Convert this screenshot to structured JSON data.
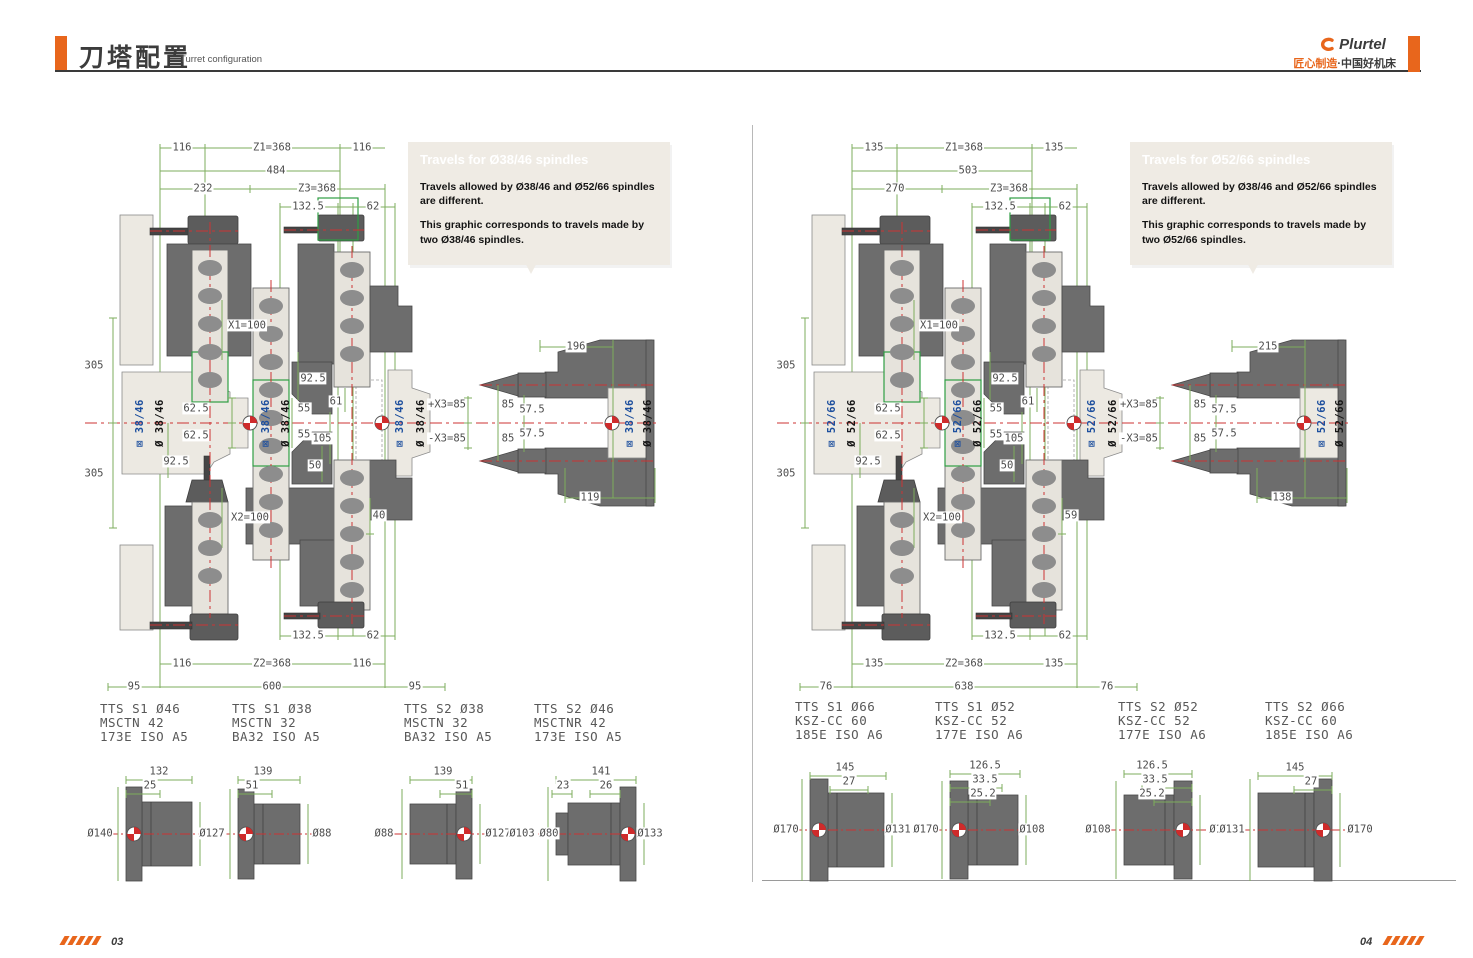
{
  "header": {
    "title_cn": "刀塔配置",
    "title_en": "Turret configuration",
    "brand": "Plurtel",
    "tagline_orange": "匠心制造",
    "tagline_dark": "·中国好机床"
  },
  "footer": {
    "page_left": "03",
    "page_right": "04"
  },
  "colors": {
    "accent_orange": "#E8661C",
    "dimension_green": "#7dad5c",
    "highlight_green": "#2f9e44",
    "centerline_red": "#cc3333",
    "spindle_blue": "#1d4f9e",
    "machine_gray": "#6d6d6d",
    "machine_beige": "#ECE9E2",
    "callout_bg": "#EFEBE4"
  },
  "left_panel": {
    "callout": {
      "title": "Travels for Ø38/46 spindles",
      "para1": "Travels allowed by Ø38/46  and Ø52/66  spindles are different.",
      "para2": "This graphic corresponds to travels made by two Ø38/46  spindles."
    },
    "spindle_blue": "⊠ 38/46",
    "spindle_black": "Ø 38/46",
    "dims": {
      "top1_l": "116",
      "top1_c": "Z1=368",
      "top1_r": "116",
      "top2": "484",
      "top3_l": "232",
      "top3_r": "Z3=368",
      "top4_l": "132.5",
      "top4_r": "62",
      "v305a": "305",
      "v305b": "305",
      "x1": "X1=100",
      "x2": "X2=100",
      "d625a": "62.5",
      "d625b": "62.5",
      "d925a": "92.5",
      "d925b": "92.5",
      "d61": "61",
      "d55a": "55",
      "d55b": "55",
      "d105": "105",
      "d50": "50",
      "d40": "40",
      "d196": "196",
      "xp": "+X3=85",
      "xm": "-X3=85",
      "d85a": "85",
      "d85b": "85",
      "d575a": "57.5",
      "d575b": "57.5",
      "d119": "119",
      "bot1_l": "132.5",
      "bot1_r": "62",
      "bot2_l": "116",
      "bot2_c": "Z2=368",
      "bot2_r": "116",
      "bot3_l": "95",
      "bot3_c": "600",
      "bot3_r": "95"
    },
    "parts": [
      {
        "line1": "TTS S1 Ø46",
        "line2": "MSCTN 42",
        "line3": "173E ISO A5"
      },
      {
        "line1": "TTS S1 Ø38",
        "line2": "MSCTN 32",
        "line3": "BA32 ISO A5"
      },
      {
        "line1": "TTS S2 Ø38",
        "line2": "MSCTN 32",
        "line3": "BA32 ISO A5"
      },
      {
        "line1": "TTS S2 Ø46",
        "line2": "MSCTNR 42",
        "line3": "173E ISO A5"
      }
    ],
    "tools": [
      {
        "d1": "132",
        "d2": "25",
        "dl": "Ø140",
        "dr": "Ø98"
      },
      {
        "d1": "139",
        "d2": "51",
        "dl": "Ø127",
        "dr": "Ø88"
      },
      {
        "d1": "139",
        "d2": "51",
        "dl": "Ø88",
        "dr": "Ø127"
      },
      {
        "d1": "141",
        "d2": "23",
        "d3": "26",
        "dl": "Ø103",
        "dl2": "Ø80",
        "dr": "Ø133"
      }
    ]
  },
  "right_panel": {
    "callout": {
      "title": "Travels for Ø52/66 spindles",
      "para1": "Travels allowed by Ø38/46  and Ø52/66  spindles are different.",
      "para2": "This graphic corresponds to travels made by two Ø52/66  spindles."
    },
    "spindle_blue": "⊠ 52/66",
    "spindle_black": "Ø 52/66",
    "dims": {
      "top1_l": "135",
      "top1_c": "Z1=368",
      "top1_r": "135",
      "top2": "503",
      "top3_l": "270",
      "top3_r": "Z3=368",
      "top4_l": "132.5",
      "top4_r": "62",
      "v305a": "305",
      "v305b": "305",
      "x1": "X1=100",
      "x2": "X2=100",
      "d625a": "62.5",
      "d625b": "62.5",
      "d925a": "92.5",
      "d925b": "92.5",
      "d61": "61",
      "d55a": "55",
      "d55b": "55",
      "d105": "105",
      "d50": "50",
      "d40": "59",
      "d196": "215",
      "xp": "+X3=85",
      "xm": "-X3=85",
      "d85a": "85",
      "d85b": "85",
      "d575a": "57.5",
      "d575b": "57.5",
      "d119": "138",
      "bot1_l": "132.5",
      "bot1_r": "62",
      "bot2_l": "135",
      "bot2_c": "Z2=368",
      "bot2_r": "135",
      "bot3_l": "76",
      "bot3_c": "638",
      "bot3_r": "76"
    },
    "parts": [
      {
        "line1": "TTS S1 Ø66",
        "line2": "KSZ-CC 60",
        "line3": "185E ISO A6"
      },
      {
        "line1": "TTS S1 Ø52",
        "line2": "KSZ-CC 52",
        "line3": "177E ISO A6"
      },
      {
        "line1": "TTS S2 Ø52",
        "line2": "KSZ-CC 52",
        "line3": "177E ISO A6"
      },
      {
        "line1": "TTS S2 Ø66",
        "line2": "KSZ-CC 60",
        "line3": "185E ISO A6"
      }
    ],
    "tools": [
      {
        "d1": "145",
        "d2": "27",
        "dl": "Ø170",
        "dr": "Ø131"
      },
      {
        "d1": "126.5",
        "d2": "33.5",
        "d3": "25.2",
        "dl": "Ø170",
        "dr": "Ø108"
      },
      {
        "d1": "126.5",
        "d2": "33.5",
        "d3": "25.2",
        "dl": "Ø108",
        "dr": "Ø170"
      },
      {
        "d1": "145",
        "d2": "27",
        "dl": "Ø131",
        "dr": "Ø170"
      }
    ]
  }
}
